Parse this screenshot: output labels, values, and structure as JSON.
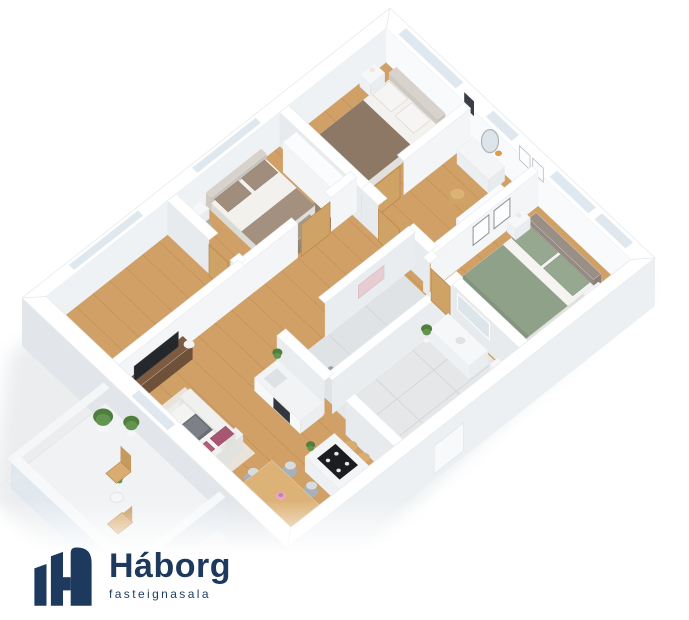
{
  "brand": {
    "name": "Háborg",
    "tagline": "fasteignasala",
    "logo_color": "#1d3a5e",
    "icon": "h-bars-icon"
  },
  "scene": {
    "type": "3d-floorplan-render",
    "palette": {
      "wood": "#d0a066",
      "woodEdge": "#b9884e",
      "plank": "#a97f45",
      "wallTop": "#ffffff",
      "wallStroke": "#e6eaed",
      "innerNE": "#f8fafc",
      "innerNW": "#eef2f5",
      "faceSW": "#e7ebee",
      "faceSE": "#f3f5f7",
      "extSE": "#edf0f3",
      "extSW": "#e2e6ea",
      "glass": "#dfe8ee",
      "tile": "#e5e7e9",
      "tileLine": "#cdd2d6",
      "marble": "#eaedef",
      "shadow": "#d3d8dd",
      "duvetBrown": "#8d7866",
      "duvetBrownDk": "#7c6a5a",
      "duvetSage": "#90a189",
      "sageDk": "#84957d",
      "pillowSage": "#97a890",
      "pillowTaupe": "#a08d7b",
      "headboard": "#d7d2cb",
      "headboardDk": "#9a8f86",
      "whiteFurn": "#f6f7f8",
      "rugDark": "#6f6154",
      "rugBeige": "#e8e1d3",
      "rugGray": "#8c7e71",
      "sofa": "#ededeb",
      "sofaShade": "#dfdfdc",
      "blanket": "#6a6e74",
      "blanketLt": "#7d8187",
      "magenta": "#a85672",
      "magenta2": "#b06079",
      "tableWood": "#d4a56a",
      "tableTop": "#ddb277",
      "tableSide": "#c0904f",
      "chairGray": "#aab0b6",
      "chairSeat": "#d9dcdf",
      "stool": "#d9ad72",
      "console": "#6f5038",
      "consoleTop": "#7e5b40",
      "consoleDk": "#5f452f",
      "tv": "#24272b",
      "cooktop": "#1b1d20",
      "oven": "#33373b",
      "plant": "#4f7d3c",
      "plantLight": "#639450",
      "pot": "#f4f6f7",
      "doorTan": "#cfa265",
      "doorTanDk": "#b8854b",
      "towel": "#e7cdd1",
      "benchTaupe": "#a89a8b",
      "flower": "#e5aac9",
      "flowerDk": "#c97fa8",
      "orangeFlower": "#e09a4e",
      "mirror": "#dde5ea",
      "mirrorFrame": "#aeb5ba"
    },
    "rooms": [
      {
        "id": "bedroom-north",
        "floor": "wood"
      },
      {
        "id": "bedroom-northwest",
        "floor": "wood"
      },
      {
        "id": "vanity-room",
        "floor": "wood"
      },
      {
        "id": "bedroom-east",
        "floor": "wood"
      },
      {
        "id": "shower-room",
        "floor": "tile"
      },
      {
        "id": "bathroom",
        "floor": "tile"
      },
      {
        "id": "hallway",
        "floor": "wood"
      },
      {
        "id": "west-room",
        "floor": "wood"
      },
      {
        "id": "living-room",
        "floor": "wood"
      },
      {
        "id": "kitchen",
        "floor": "wood"
      },
      {
        "id": "dining-area",
        "floor": "wood"
      },
      {
        "id": "balcony",
        "floor": "deck"
      }
    ],
    "furniture": [
      "double-bed-brown",
      "single-bed-taupe",
      "wardrobe",
      "vanity-table",
      "oval-mirror",
      "pouf",
      "armchair-gray",
      "double-bed-sage",
      "art-frames",
      "nightstands",
      "bath-vanity",
      "toilet",
      "shower",
      "towel",
      "kitchen-counter",
      "oven",
      "sink",
      "kitchen-island",
      "cooktop",
      "bar-stools",
      "dining-table",
      "dining-chairs",
      "sofa",
      "throw-blanket",
      "accent-pillows",
      "tv",
      "tv-console",
      "potted-plants",
      "balcony-chairs",
      "balcony-table",
      "glass-railing"
    ]
  }
}
